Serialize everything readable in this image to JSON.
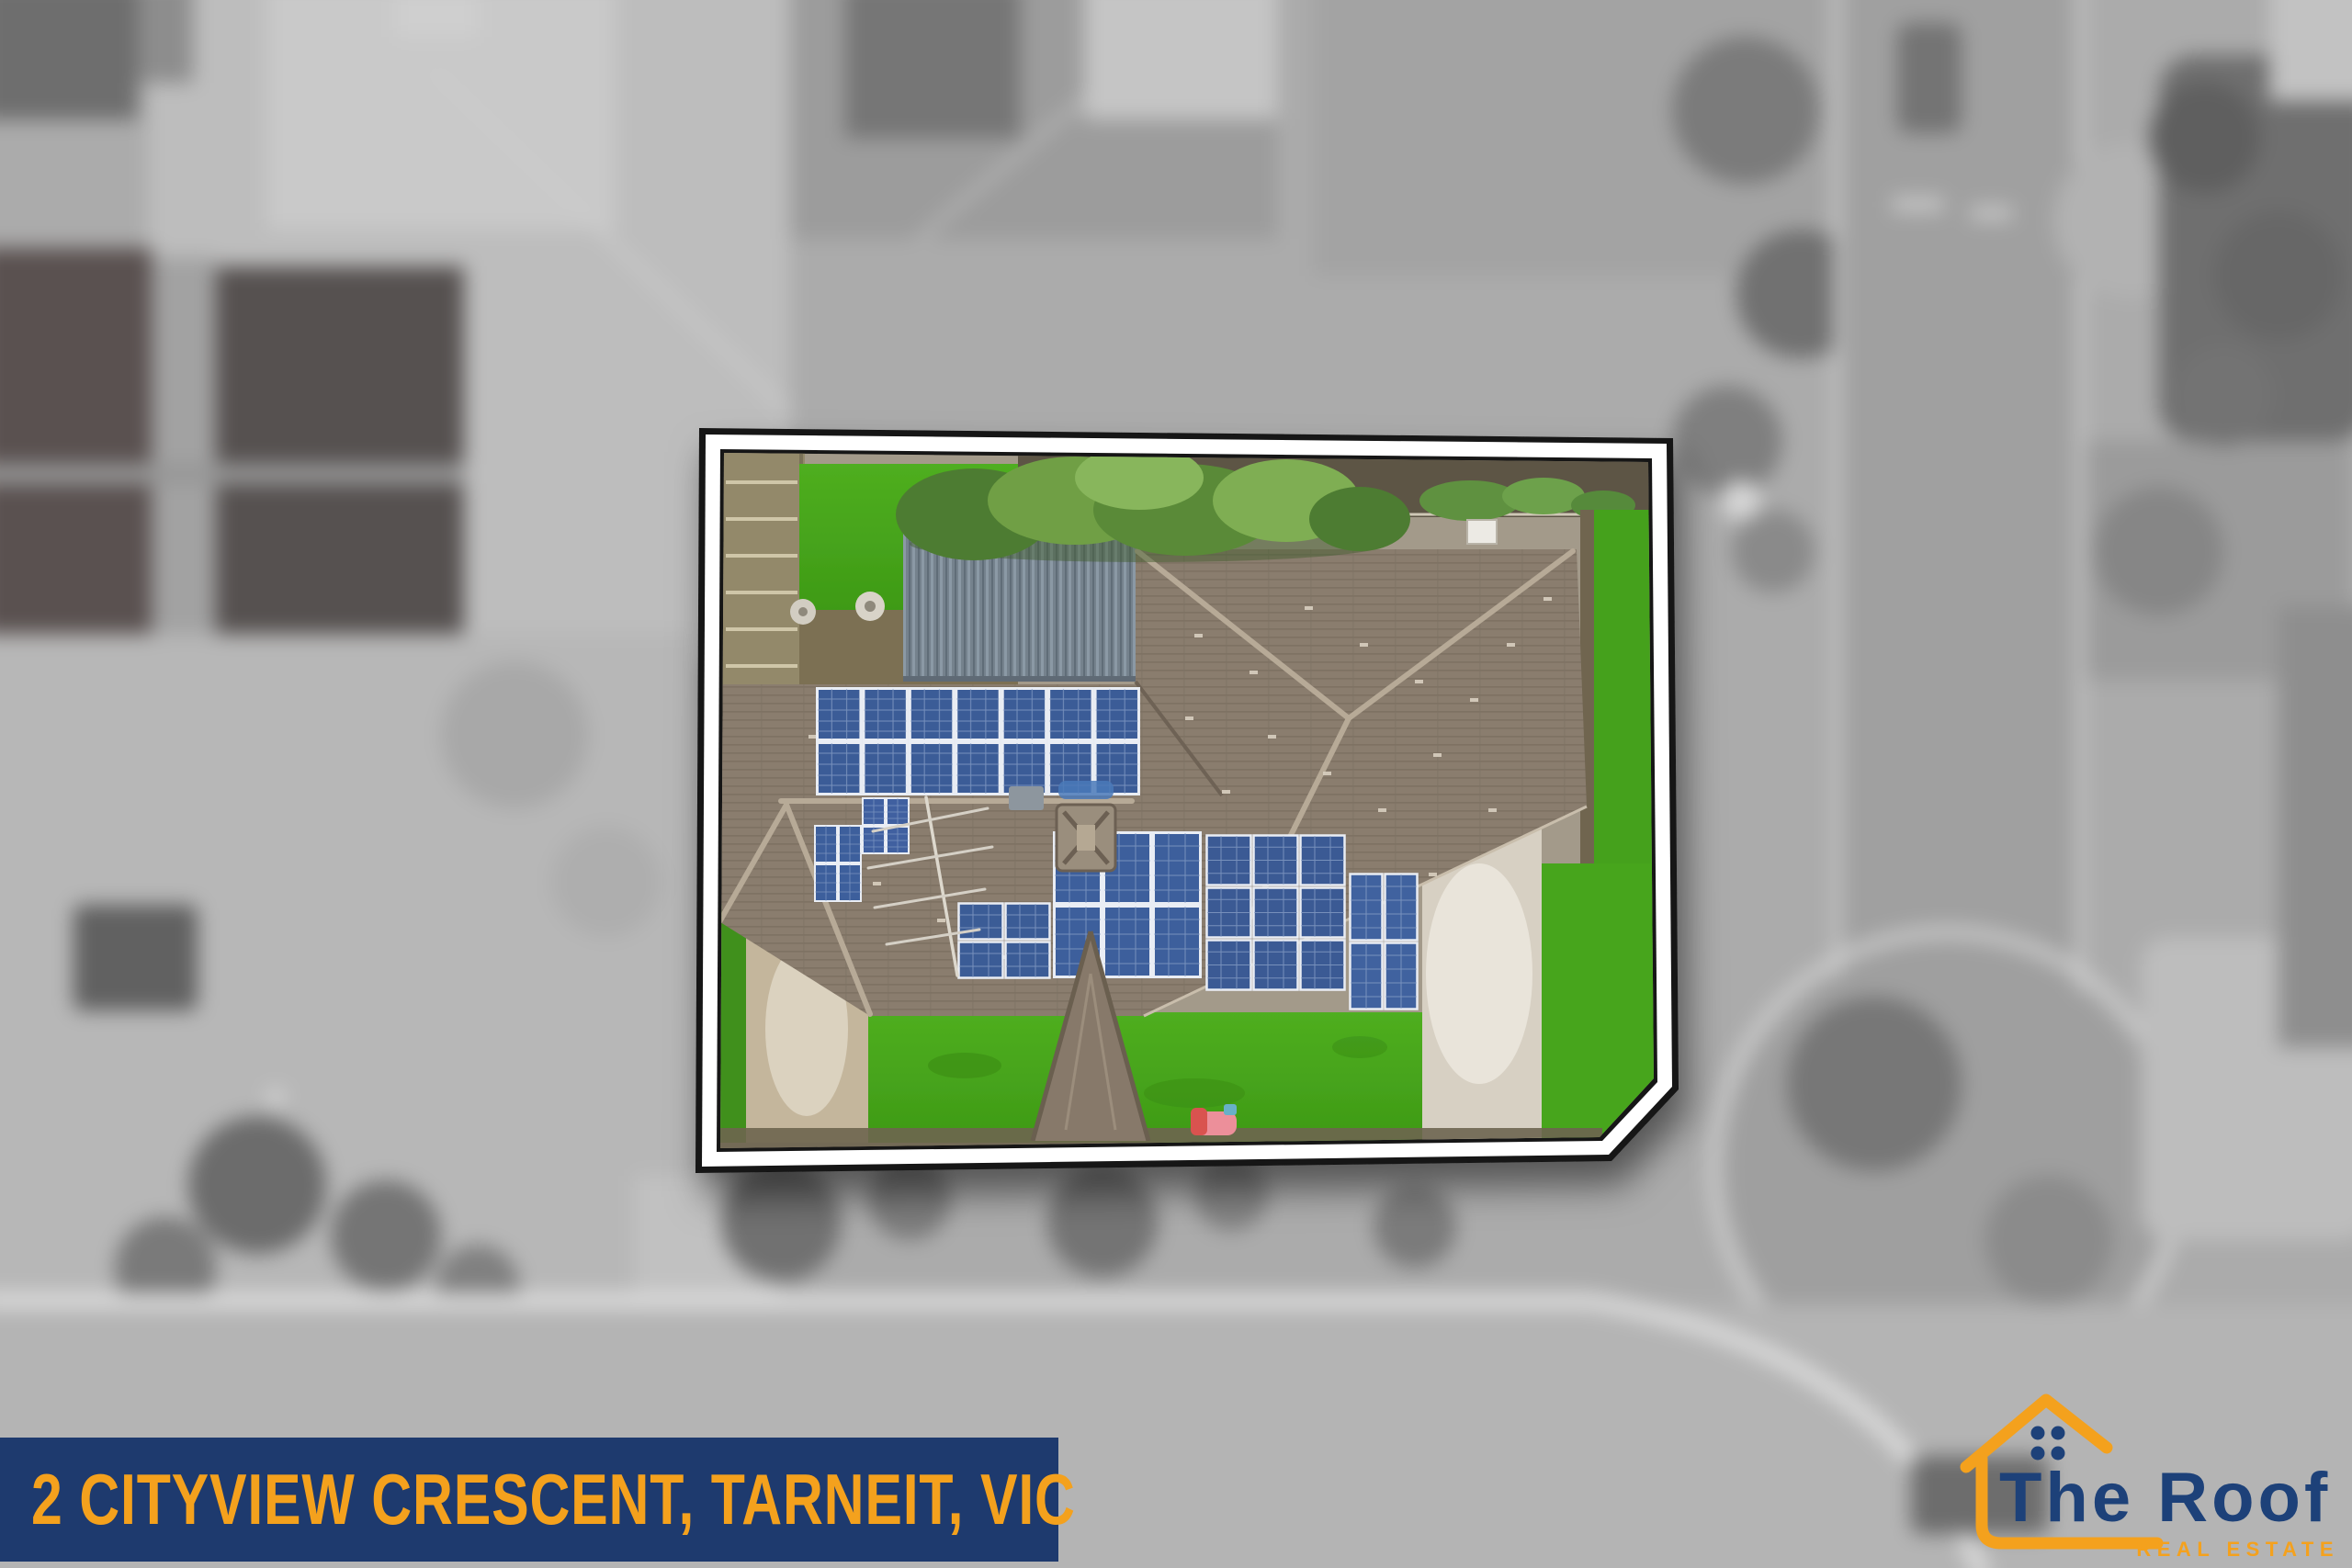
{
  "image_type": "real-estate-aerial-marketing-image",
  "address_banner": {
    "text": "2 CITYVIEW CRESCENT, TARNEIT, VIC"
  },
  "logo": {
    "name": "The Roof",
    "tagline": "REAL ESTATE",
    "icon": "house-outline-with-window-dots-icon"
  },
  "colors": {
    "banner-navy": "#1e3a6e",
    "accent-orange": "#f4a11d",
    "logo-blue": "#1d4179",
    "lawn-green": "#46a41d",
    "solar-blue": "#3b5c97",
    "roof-taupe": "#8a7d6e"
  },
  "property_photo": {
    "highlight_style": "color cutout with black and white sticker border over blurred grayscale aerial",
    "features": [
      "hip tiled roof",
      "solar panel arrays",
      "metal garage roof",
      "front lawn",
      "driveway",
      "tree canopy",
      "porch gable",
      "tv antenna",
      "roof vent",
      "pink play toy"
    ]
  }
}
